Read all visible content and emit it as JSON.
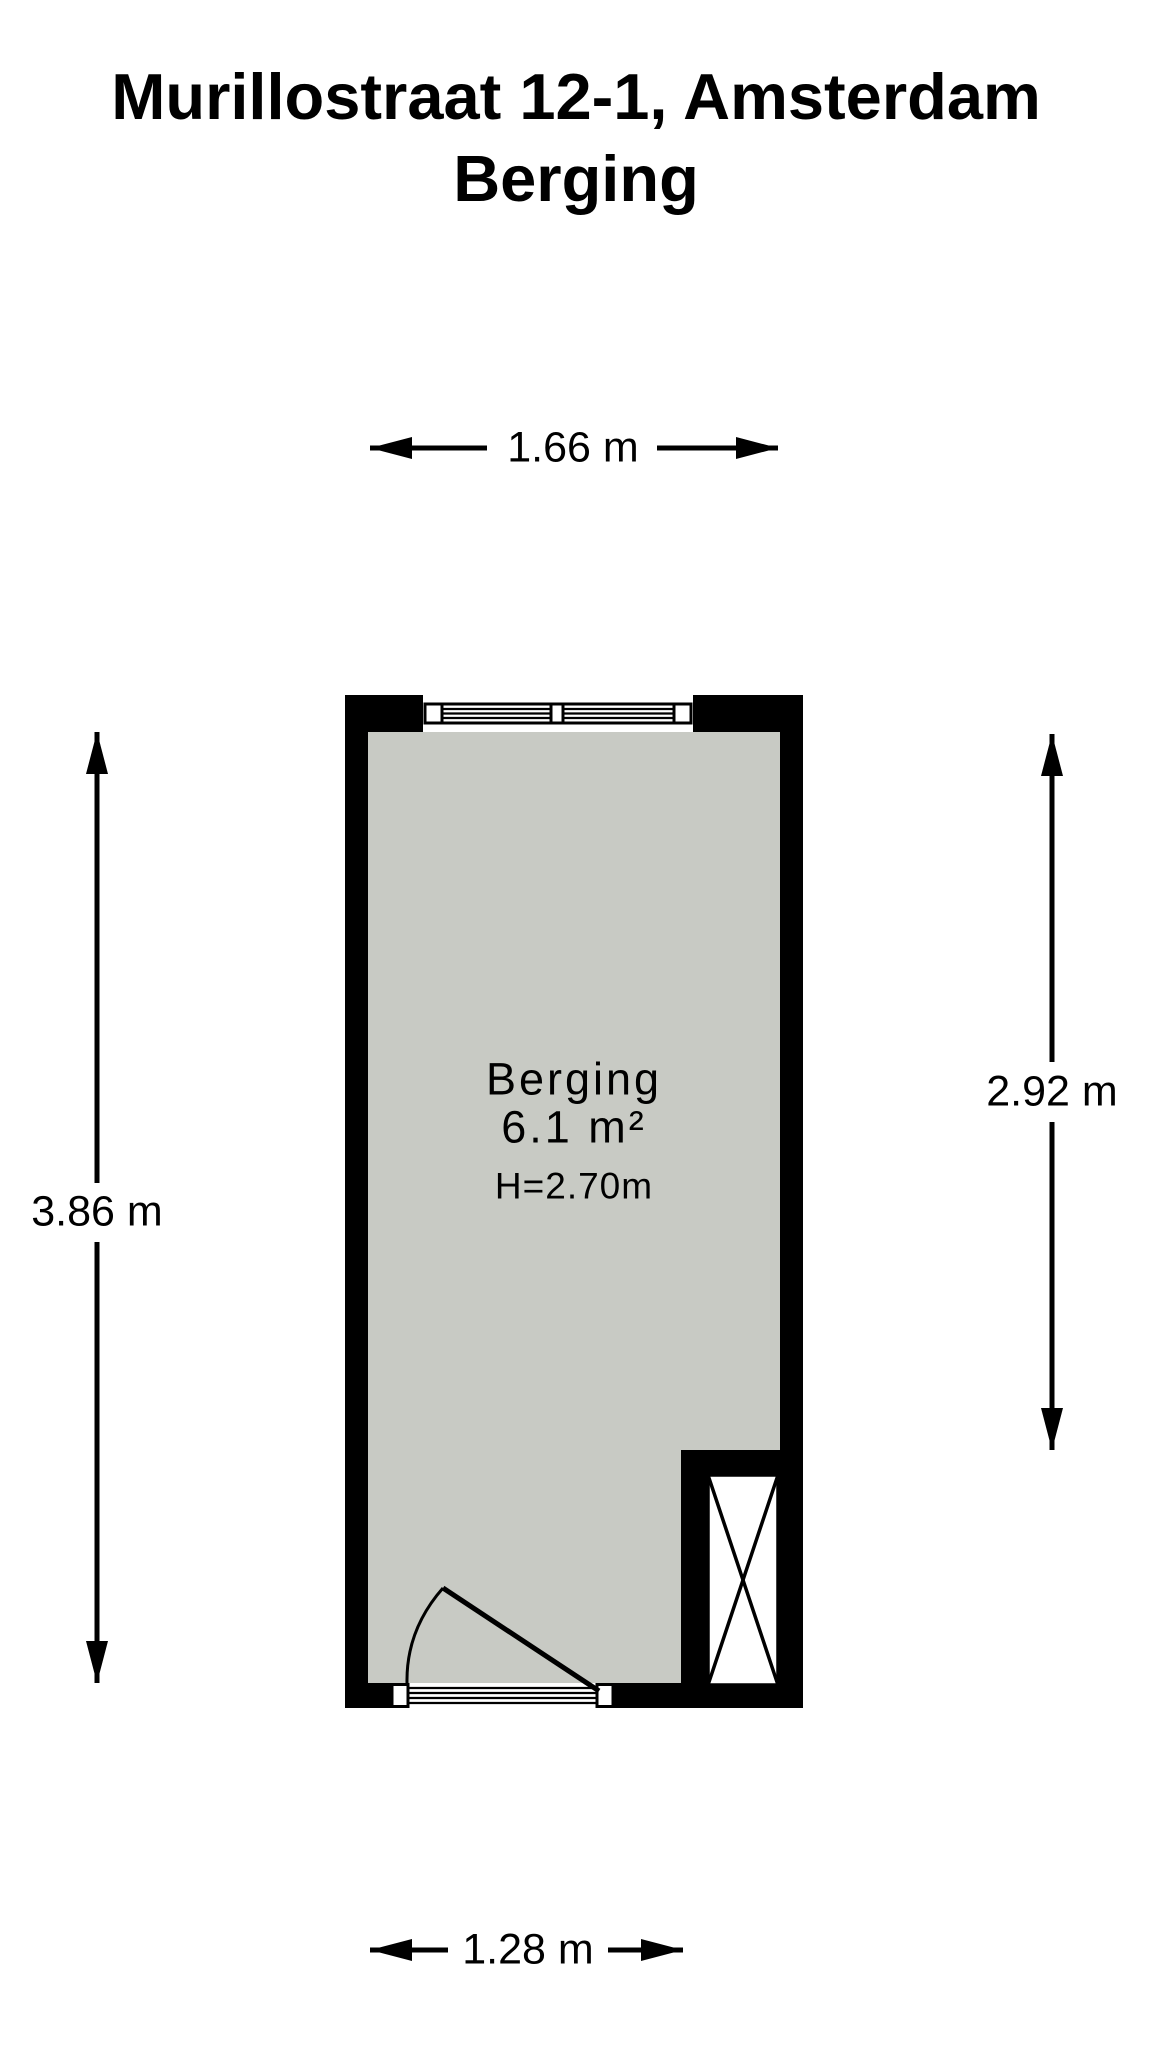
{
  "title": {
    "line1": "Murillostraat 12-1, Amsterdam",
    "line2": "Berging"
  },
  "room": {
    "name": "Berging",
    "area": "6.1 m²",
    "ceiling_height": "H=2.70m"
  },
  "dimensions": {
    "width_top": "1.66 m",
    "width_bottom": "1.28 m",
    "height_left": "3.86 m",
    "height_right": "2.92 m"
  },
  "colors": {
    "wall": "#000000",
    "floor": "#c8cac4",
    "background": "#ffffff",
    "line": "#000000"
  }
}
